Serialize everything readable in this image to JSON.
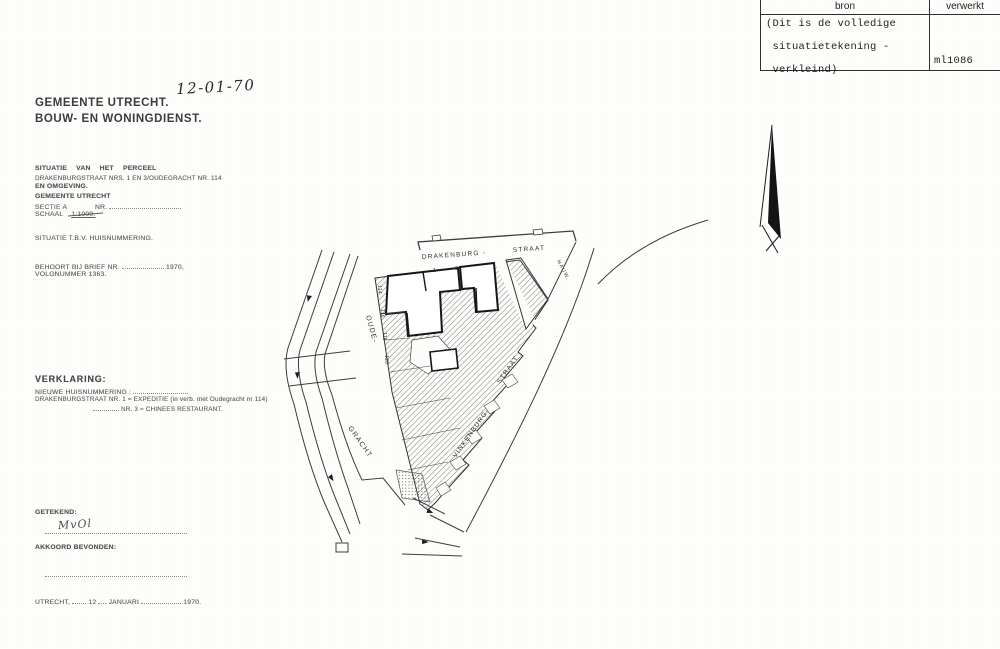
{
  "stamp": {
    "col_bron": "bron",
    "col_verwerkt": "verwerkt",
    "note_line1": "(Dit is de volledige",
    "note_line2": " situatietekening -",
    "note_line3": " verkleind)",
    "code": "ml1086"
  },
  "header": {
    "date_handwritten": "12-01-70",
    "org_line1": "GEMEENTE UTRECHT.",
    "org_line2": "BOUW- EN WONINGDIENST."
  },
  "situation": {
    "title": "SITUATIE VAN HET PERCEEL",
    "line1": "DRAKENBURGSTRAAT NRS. 1 EN 3/OUDEGRACHT NR. 114",
    "line2": "EN OMGEVING.",
    "gemeente": "GEMEENTE UTRECHT",
    "sectie_label": "SECTIE A",
    "nr_label": "NR.",
    "schaal_label": "SCHAAL",
    "schaal_value": "1:1000.",
    "purpose": "SITUATIE T.B.V. HUISNUMMERING.",
    "brief_label": "BEHOORT BIJ BRIEF NR.",
    "brief_year": "1970,",
    "volgnummer": "VOLGNUMMER 1363."
  },
  "verklaring": {
    "title": "VERKLARING:",
    "line1": "NIEUWE HUISNUMMERING :",
    "line2a": "DRAKENBURGSTRAAT NR. 1",
    "line2b": "= EXPEDITIE (in verb. met Oudegracht nr 114)",
    "line3a": "NR. 3",
    "line3b": "= CHINEES RESTAURANT."
  },
  "signoff": {
    "getekend": "GETEKEND:",
    "signature": "MvOl",
    "akkoord": "AKKOORD BEVONDEN:",
    "city": "UTRECHT,",
    "day": "12",
    "month": "JANUARI",
    "year": "1970."
  },
  "map": {
    "labels": {
      "drakenburg": "DRAKENBURG -",
      "straat_top": "STRAAT",
      "nauwe": "NAUW.",
      "oude": "OUDE-",
      "gracht": "GRACHT",
      "vinkenburg": "VINKENBURG-",
      "straat_diag": "STRAAT"
    },
    "house_numbers": [
      "114",
      "116",
      "118",
      "120"
    ],
    "parcel_numbers": [
      "1",
      "3"
    ]
  }
}
